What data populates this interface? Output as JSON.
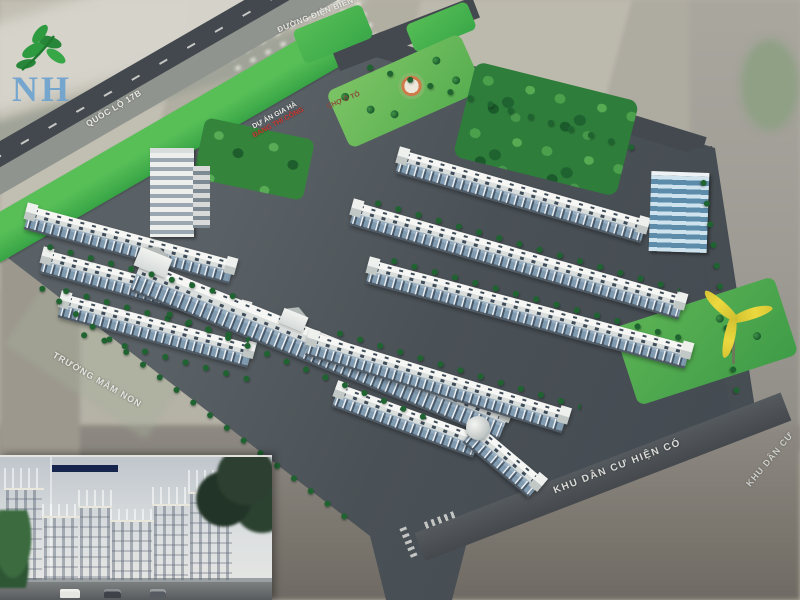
{
  "watermark": {
    "logo_text": "NH",
    "logo_icon": "leaf-icon"
  },
  "labels": {
    "road_top": "ĐƯỜNG ĐIỆN BIÊN PHỦ",
    "highway": "QUỐC LỘ 17B",
    "market": "CHỢ Ô TÔ",
    "project_line1": "DỰ ÁN GIA HÀ",
    "project_line2": "ĐANG THI CÔNG",
    "kindergarten": "TRƯỜNG MẦM NON",
    "existing_area_main": "KHU DÂN CƯ HIỆN CÓ",
    "existing_area_edge": "KHU DÂN CƯ"
  },
  "colors": {
    "green_belt": "#46b14b",
    "park_lawn": "#6cbf5d",
    "woodland": "#2e7d3b",
    "asphalt": "#4a5156",
    "roof_white": "#f2f4f1",
    "facade_blue": "#7e96a9",
    "logo_blue": "#6ea3cf",
    "leaf_green": "#2f9b40",
    "label_white": "#e9eae6",
    "label_red": "#cc3b32",
    "windmill_yellow": "#e5d23a"
  }
}
